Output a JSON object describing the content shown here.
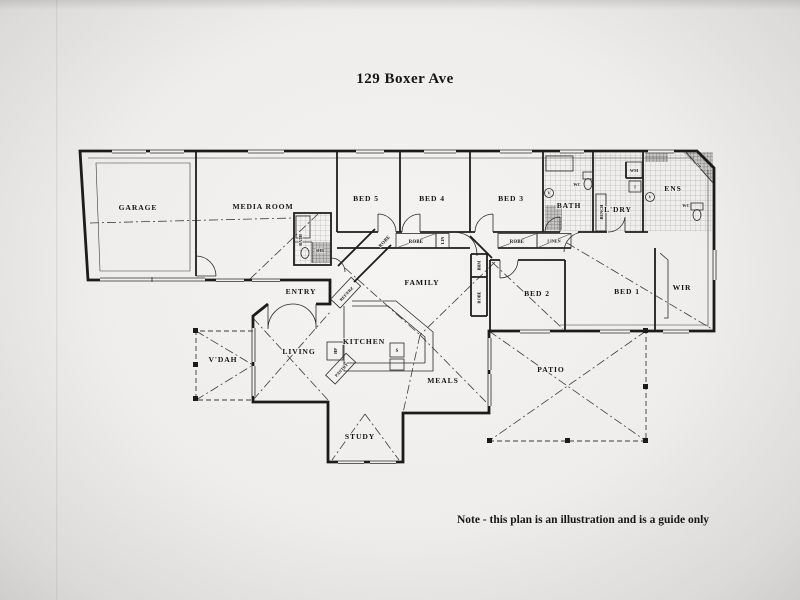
{
  "page": {
    "title": "129 Boxer Ave",
    "note": "Note - this plan is an illustration and is a guide only"
  },
  "rooms": {
    "garage": "GARAGE",
    "media_room": "MEDIA ROOM",
    "bed5": "BED 5",
    "bed4": "BED 4",
    "bed3": "BED 3",
    "bath": "BATH",
    "ldry": "L'DRY",
    "ens": "ENS",
    "wir": "WIR",
    "bed1": "BED 1",
    "bed2": "BED 2",
    "family": "FAMILY",
    "entry": "ENTRY",
    "living": "LIVING",
    "kitchen": "KITCHEN",
    "meals": "MEALS",
    "patio": "PATIO",
    "vdah": "V'DAH",
    "study": "STUDY"
  },
  "fixtures": {
    "robe": "ROBE",
    "lin": "LIN",
    "linen": "LINEN",
    "brm": "BRM",
    "wc": "WC",
    "wm": "WM",
    "t": "T",
    "bench": "BENCH",
    "v": "V",
    "shr": "SHR",
    "bath_small": "BATH",
    "dr": "DR",
    "ref": "REF/FRZ",
    "pantry": "PANTRY",
    "hp": "HP",
    "s": "S"
  },
  "colors": {
    "ink": "#1b1b1b",
    "paper": "#f1f0ee"
  }
}
